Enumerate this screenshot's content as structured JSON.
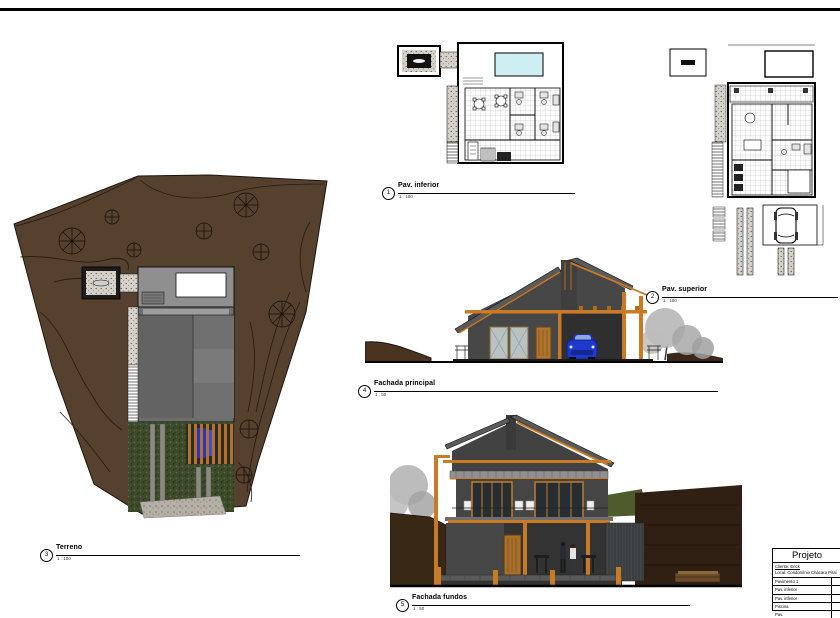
{
  "sheet": {
    "viewports": [
      {
        "number": "1",
        "title": "Pav. inferior",
        "scale": "1 : 100"
      },
      {
        "number": "2",
        "title": "Pav. superior",
        "scale": "1 : 100"
      },
      {
        "number": "3",
        "title": "Terreno",
        "scale": "1 : 100"
      },
      {
        "number": "4",
        "title": "Fachada principal",
        "scale": "1 : 50"
      },
      {
        "number": "5",
        "title": "Fachada fundos",
        "scale": "1 : 50"
      }
    ],
    "titleblock": {
      "header": "Projeto",
      "client": "Cliente: Erick",
      "location": "Local: Condomínio Chácara Piraí",
      "rows": [
        {
          "label": "Pavimento 1",
          "value": ""
        },
        {
          "label": "Pav. inferior",
          "value": ""
        },
        {
          "label": "Pav. inferior",
          "value": ""
        },
        {
          "label": "Piscina",
          "value": ""
        },
        {
          "label": "Pav.",
          "value": ""
        }
      ]
    },
    "colors": {
      "terrain_brown": "#55412e",
      "contour_dark": "#241a10",
      "roof_gray": "#6e6e6e",
      "wall_dark": "#474747",
      "timber_orange": "#c87a25",
      "pool_blue": "#cdeef2",
      "vegetation_green": "#3e4c2b",
      "car_blue": "#1f39cf",
      "tree_gray": "#b3b3b3",
      "earth_dark": "#33231a",
      "slope_green": "#4e5c2c"
    }
  }
}
